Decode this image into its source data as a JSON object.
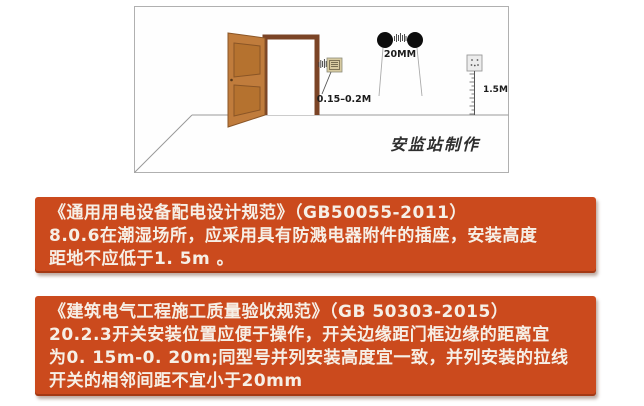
{
  "page": {
    "background": "#ffffff",
    "accent": "#cb4a1d",
    "text_on_accent": "#f6efe6"
  },
  "diagram": {
    "labels": {
      "switch_distance": "0.15–0.2M",
      "pull_switch_gap": "20MM",
      "socket_height": "1.5M",
      "watermark": "安监站制作"
    },
    "colors": {
      "door_leaf": "#c07c3c",
      "door_panel": "#b5722f",
      "door_frame": "#7b4426",
      "panel_border": "#b0b0b0",
      "pull_switch": "#0d0d0d",
      "switch_plate": "#d8cba1",
      "socket_plate": "#ececec"
    }
  },
  "regulation_boxes": [
    {
      "lines": [
        "《通用用电设备配电设计规范》（GB50055-2011）",
        "8.0.6在潮湿场所，应采用具有防溅电器附件的插座，安装高度",
        "距地不应低于1. 5m 。"
      ]
    },
    {
      "lines": [
        "《建筑电气工程施工质量验收规范》（GB 50303-2015）",
        "20.2.3开关安装位置应便于操作，开关边缘距门框边缘的距离宜",
        "为0. 15m-0. 20m;同型号并列安装高度宜一致，并列安装的拉线",
        "开关的相邻间距不宜小于20mm"
      ]
    }
  ]
}
